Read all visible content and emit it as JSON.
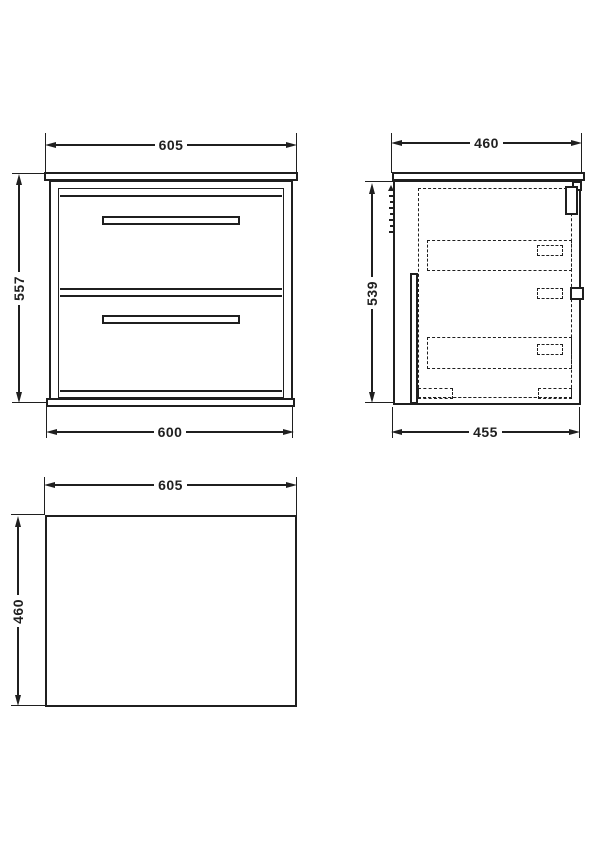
{
  "views": {
    "front": {
      "width_top": "605",
      "height": "557",
      "width_bottom": "600"
    },
    "side": {
      "depth_top": "460",
      "height": "539",
      "depth_bottom": "455"
    },
    "plan": {
      "width": "605",
      "depth": "460"
    }
  },
  "colors": {
    "line": "#1f1f1f",
    "background": "#ffffff"
  }
}
